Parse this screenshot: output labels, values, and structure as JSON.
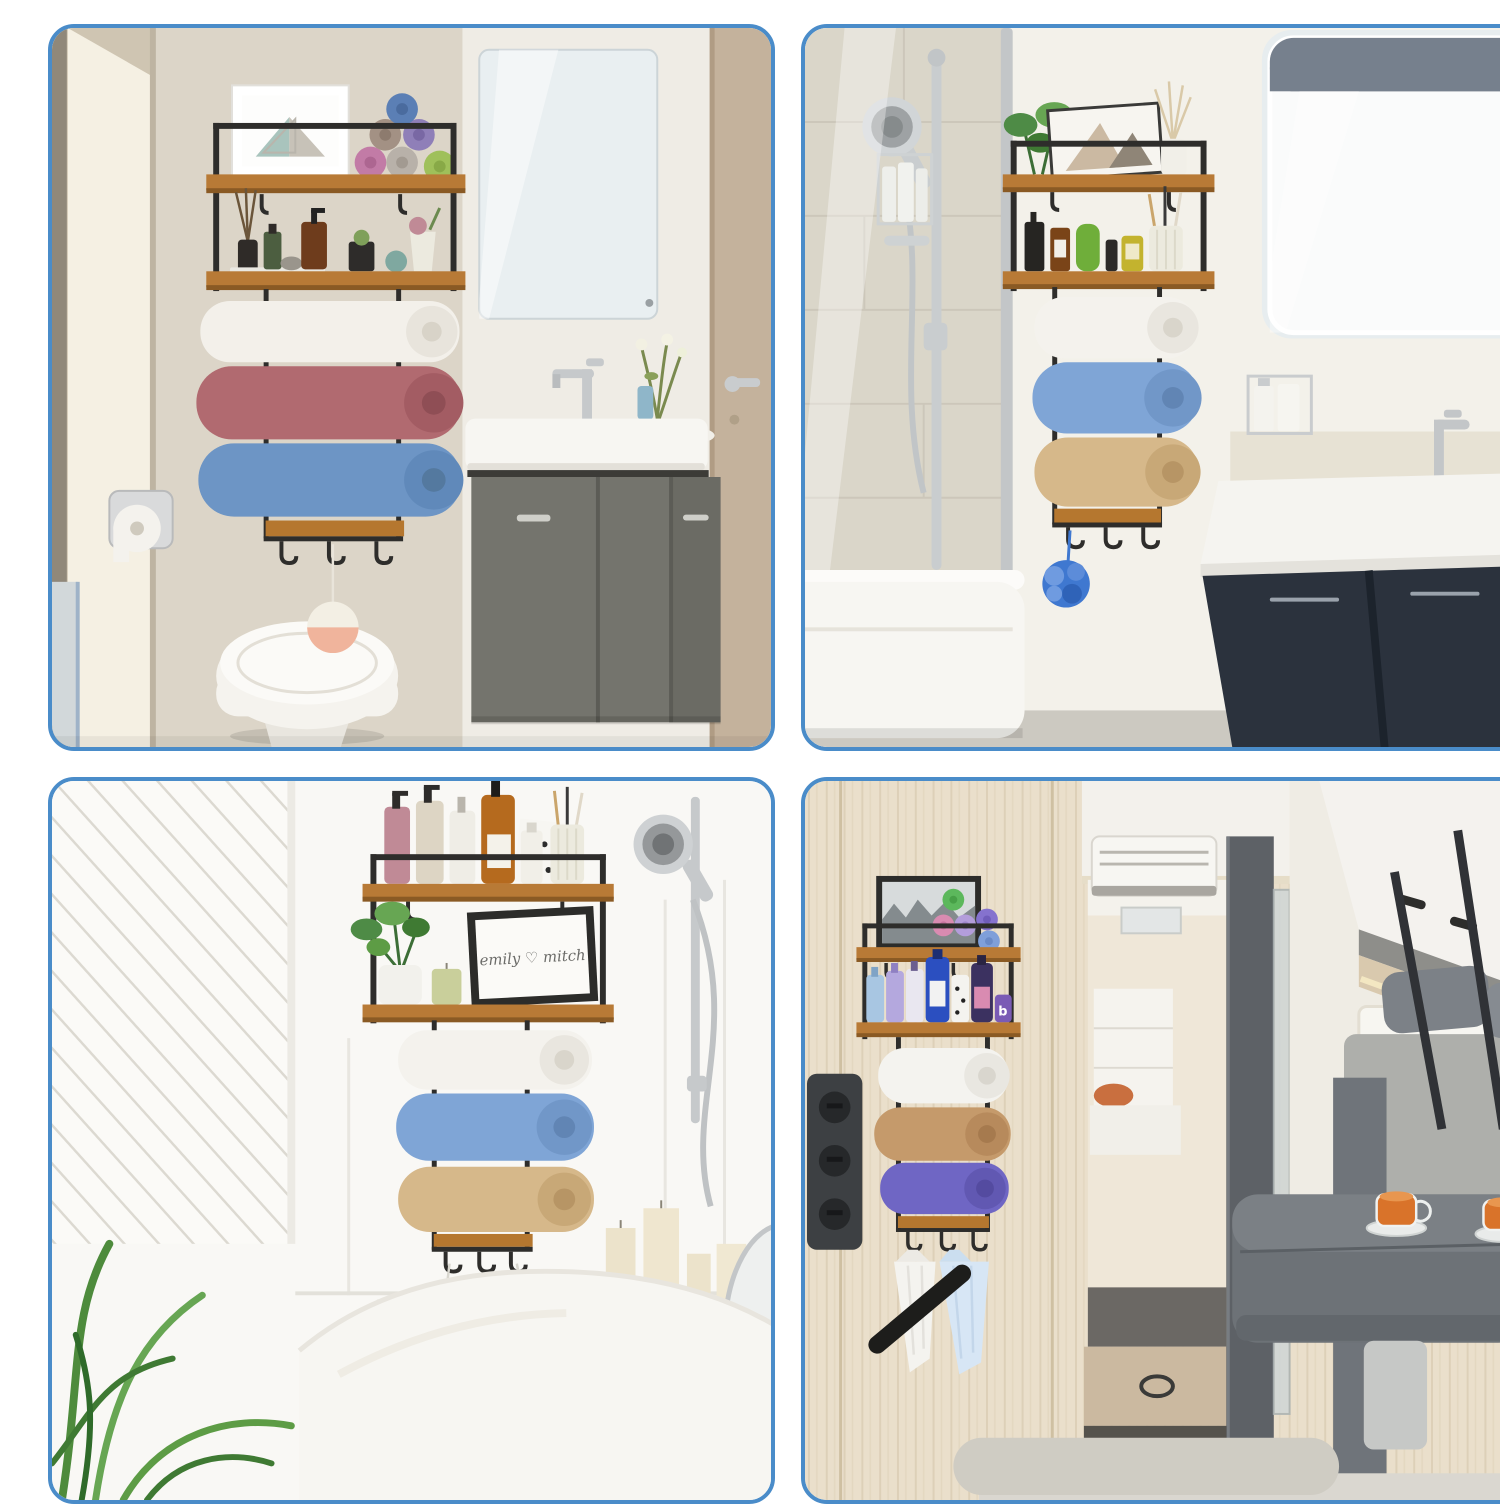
{
  "collage": {
    "grid": "2x2",
    "panel_count": 4,
    "border_color": "#4a8cc9",
    "gap_background": "#ffffff"
  },
  "product": {
    "frame_color": "#2e2d2b",
    "shelf_wood_color": "#b87a36"
  },
  "panels": [
    {
      "id": "top-left",
      "scene": "bathroom with toilet, grey floating vanity, mirror and door",
      "rack_towels": [
        "white",
        "rose",
        "blue"
      ],
      "shelf_towels": [
        "blue",
        "taupe",
        "purple",
        "pink",
        "grey",
        "green"
      ],
      "accents": {
        "pom_pom": "#f0b49c",
        "wall": "#dcd5c8",
        "vanity": "#74746d"
      }
    },
    {
      "id": "top-right",
      "scene": "bathroom with shower rail, bathtub, navy vanity and LED mirror",
      "rack_towels": [
        "white",
        "blue",
        "beige"
      ],
      "accents": {
        "loofah": "#3f78d0",
        "tile": "#d9d1c1",
        "vanity": "#2b323d"
      }
    },
    {
      "id": "bottom-left",
      "scene": "bathroom with freestanding tub, hand shower and pillar candles",
      "rack_towels": [
        "white",
        "blue",
        "beige"
      ],
      "framed_print_text": "emily ♡ mitch",
      "accents": {
        "candles": "#ece3cb",
        "plant": "#4e8b3c"
      }
    },
    {
      "id": "bottom-right",
      "scene": "camper van interior with dinette, seats and shower step",
      "rack_towels": [
        "white",
        "beige",
        "purple"
      ],
      "hanging_towels": [
        "white",
        "light-blue"
      ],
      "mini_towels": [
        "green",
        "pink",
        "lavender",
        "purple",
        "blue"
      ],
      "jar_monogram": "b",
      "accents": {
        "wood_wall": "#eadfcb",
        "table": "#6d7277",
        "tea": "#d9732a"
      }
    }
  ]
}
